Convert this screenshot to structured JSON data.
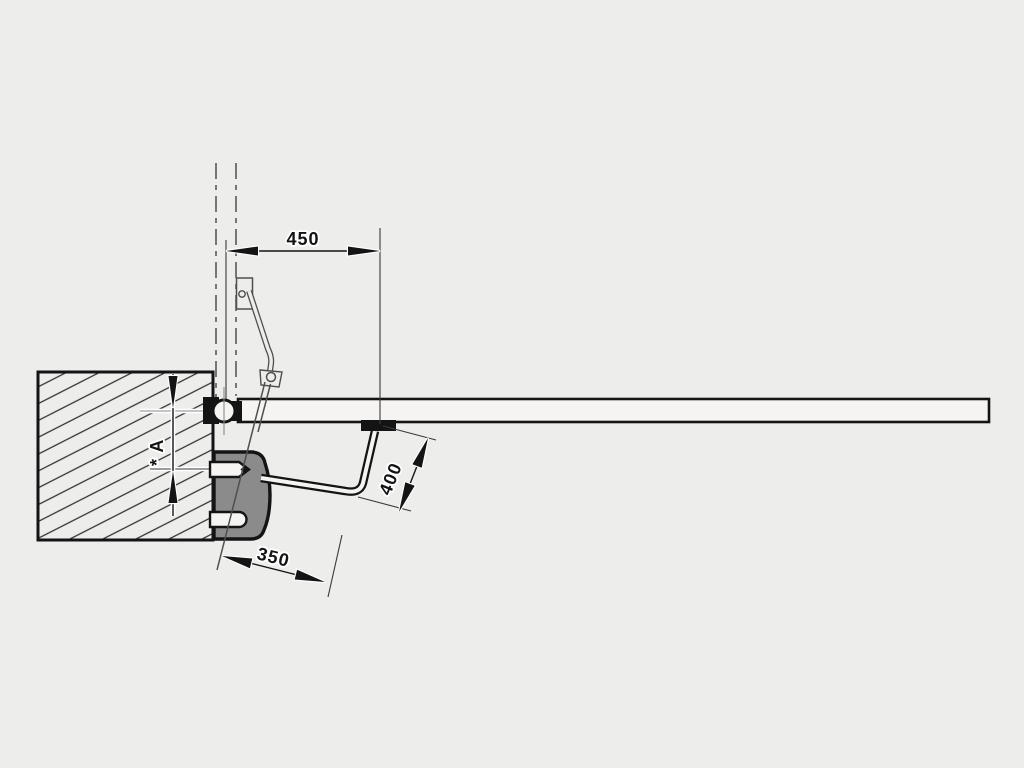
{
  "diagram": {
    "type": "technical-installation-drawing",
    "dimensions": {
      "gate_attachment_offset": "450",
      "arm_segment_long": "400",
      "arm_segment_short": "350",
      "post_offset": "* A"
    },
    "colors": {
      "background": "#ededeb",
      "line": "#141414",
      "plate": "#8b8b8b",
      "gate_fill": "#f5f4f2"
    }
  }
}
